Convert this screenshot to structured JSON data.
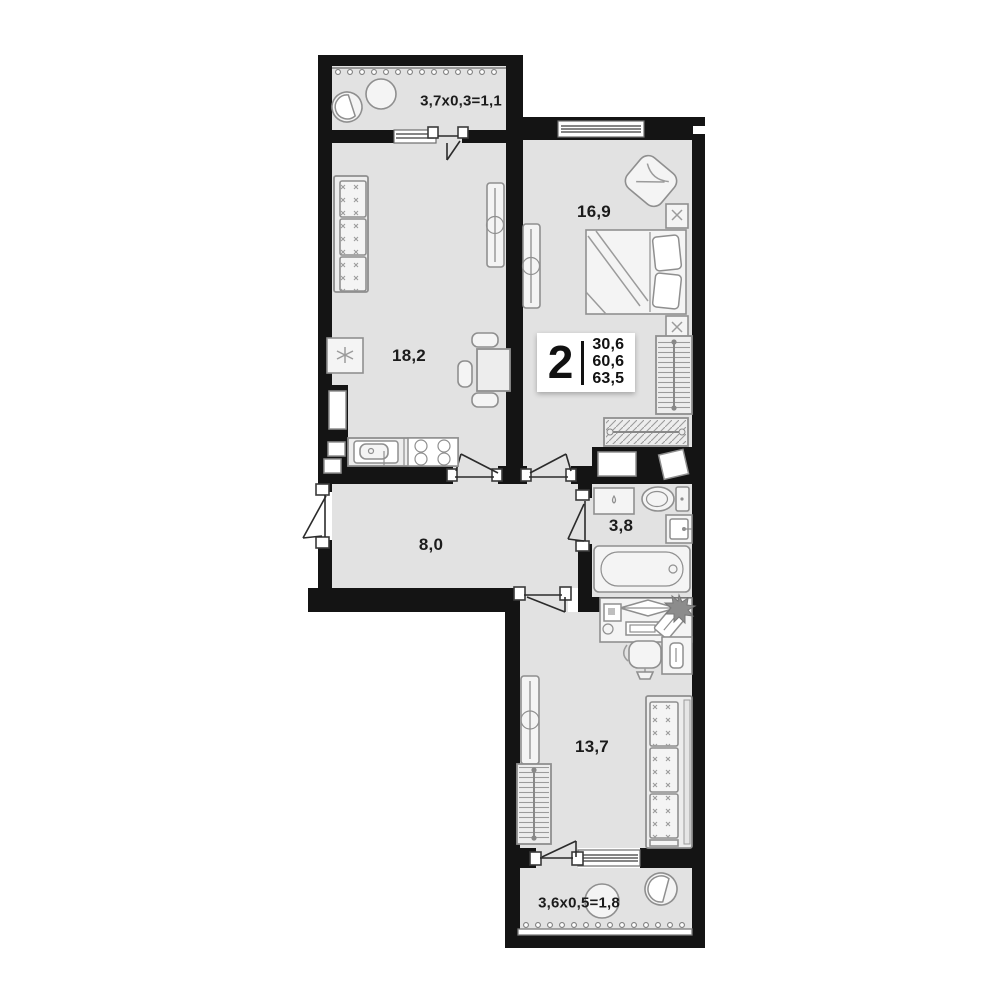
{
  "plan": {
    "badge": {
      "rooms_count": "2",
      "areas": [
        "30,6",
        "60,6",
        "63,5"
      ]
    },
    "rooms": [
      {
        "id": "balcony-top",
        "label": "3,7x0,3=1,1"
      },
      {
        "id": "kitchen",
        "label": "18,2"
      },
      {
        "id": "bedroom",
        "label": "16,9"
      },
      {
        "id": "hallway",
        "label": "8,0"
      },
      {
        "id": "bathroom",
        "label": "3,8"
      },
      {
        "id": "living-room",
        "label": "13,7"
      },
      {
        "id": "balcony-bottom",
        "label": "3,6x0,5=1,8"
      }
    ],
    "colors": {
      "wall": "#141414",
      "floor": "#e2e2e2",
      "furniture_fill": "#ededed",
      "furniture_stroke": "#8f8f8f",
      "background": "#ffffff"
    },
    "icons": [
      "sofa",
      "bed",
      "bathtub",
      "toilet",
      "bath-sink",
      "washing-machine",
      "stove",
      "kitchen-sink",
      "fridge",
      "dining-table",
      "desk",
      "office-chair",
      "wardrobe",
      "radiator",
      "balcony-chair",
      "balcony-table",
      "plant-star"
    ]
  }
}
